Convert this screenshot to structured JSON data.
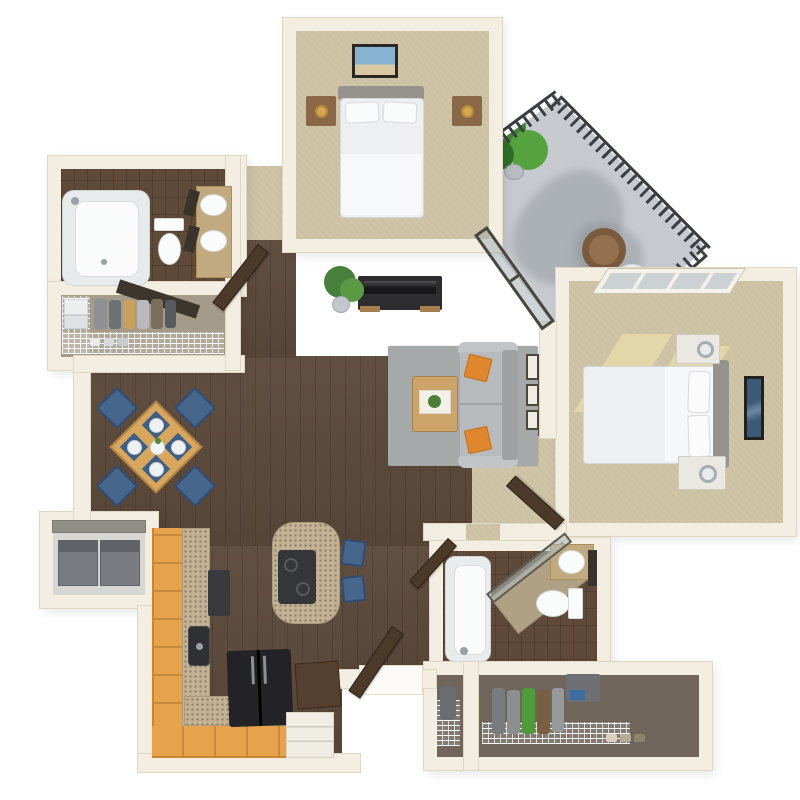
{
  "scene": {
    "description": "3D rendered top-down floor plan of a two-bedroom, two-bathroom apartment with balcony",
    "canvas_px": {
      "width": 800,
      "height": 800
    },
    "background": "#ffffff",
    "visible_text": "none"
  },
  "palette": {
    "wall": "#f3eee1",
    "wall_edge": "#ded7c4",
    "wood_floor": "#5b483a",
    "carpet": "#cdc1a4",
    "carpet_sunlight": "#e9dcab",
    "bathroom_tile": "#5f4a3a",
    "closet_floor": "#a59b8a",
    "closet2_floor": "#6f655a",
    "balcony_concrete": "#c7cbd0",
    "railing_dark": "#3d4146",
    "granite_counter": "#c3b294",
    "cabinet_orange": "#e6a34c",
    "sofa_gray": "#b7bbbd",
    "rug_gray": "#a5a9aa",
    "accent_pillow_orange": "#e0862c",
    "dining_chair_blue": "#47668c",
    "door_brown": "#4b3a29",
    "fixture_white": "#fafbfb",
    "bed_linen": "#edeff1",
    "headboard_gray": "#96938e",
    "nightstand_wood": "#8a6746",
    "nightstand_white": "#eae8e2",
    "lamp_gold": "#d2a74f",
    "plant_green": "#4f8a3c",
    "refrigerator_black": "#232327",
    "tv_black": "#17171a",
    "art_blue": "#3c5a78",
    "art_sky": "#86b4d2",
    "laundry_counter_gray": "#908f88",
    "laundry_machine_gray": "#787c80",
    "coffee_table_wood": "#cda469",
    "dining_table_wood": "#d8a75c"
  },
  "rooms": [
    {
      "id": "bedroom-1",
      "label": "Bedroom 1 (top)",
      "floor": "carpet",
      "furniture": [
        "framed-wall-art",
        "headboard",
        "double-bed",
        "two-pillows",
        "nightstand-left",
        "nightstand-right",
        "gold-table-lamps",
        "open-door"
      ]
    },
    {
      "id": "balcony",
      "label": "Balcony (top right)",
      "floor": "concrete",
      "furniture": [
        "metal-baluster-railing",
        "potted-plant",
        "round-wicker-table",
        "two-patio-chairs",
        "sliding-glass-door"
      ]
    },
    {
      "id": "bedroom-2",
      "label": "Bedroom 2 (right)",
      "floor": "carpet",
      "furniture": [
        "gridded-window",
        "sunlight-patches",
        "double-bed",
        "headboard",
        "two-pillows",
        "nightstand-top",
        "nightstand-bottom",
        "silver-lamps",
        "framed-wall-art",
        "open-door"
      ]
    },
    {
      "id": "bathroom-1",
      "label": "Bathroom 1 (top left)",
      "floor": "tile",
      "furniture": [
        "bathtub-with-shower",
        "toilet",
        "double-sink-vanity",
        "mirrors"
      ]
    },
    {
      "id": "closet-1",
      "label": "Walk-in closet (left)",
      "floor": "closet",
      "furniture": [
        "wire-shelving",
        "hanging-clothes",
        "folded-towels",
        "shoes",
        "corner-shelf"
      ]
    },
    {
      "id": "dining-area",
      "label": "Dining area",
      "floor": "wood",
      "furniture": [
        "square-dining-table",
        "four-blue-chairs",
        "four-place-settings",
        "centerpiece"
      ]
    },
    {
      "id": "living-room",
      "label": "Living room",
      "floor": "wood",
      "furniture": [
        "gray-area-rug",
        "gray-sofa",
        "two-orange-pillows",
        "coffee-table",
        "decorative-tray",
        "tv-console",
        "flat-tv",
        "potted-plant",
        "gallery-wall-frames"
      ]
    },
    {
      "id": "kitchen",
      "label": "Kitchen (bottom left)",
      "floor": "wood",
      "furniture": [
        "l-shaped-orange-cabinets",
        "granite-countertop",
        "undermount-sink",
        "wall-oven",
        "island-with-cooktop",
        "two-blue-bar-stools",
        "black-refrigerator",
        "entry-console",
        "open-shelf-cabinet"
      ]
    },
    {
      "id": "laundry",
      "label": "Laundry closet (left)",
      "floor": "laundry",
      "furniture": [
        "gray-counter",
        "washer",
        "dryer"
      ]
    },
    {
      "id": "entry",
      "label": "Entry (bottom center)",
      "floor": "wood",
      "furniture": [
        "threshold",
        "open-front-door"
      ]
    },
    {
      "id": "bathroom-2",
      "label": "Bathroom 2 (bottom right)",
      "floor": "tile",
      "furniture": [
        "bathtub",
        "glass-shower",
        "toilet",
        "sink-vanity",
        "mirror",
        "open-door"
      ]
    },
    {
      "id": "closet-2",
      "label": "Closet (bottom right)",
      "floor": "closet",
      "furniture": [
        "divider-wall",
        "wire-shelving",
        "hanging-clothes",
        "stacked-clothes",
        "shoes"
      ]
    },
    {
      "id": "hallways",
      "label": "Hallways",
      "floor": "wood-and-carpet",
      "furniture": []
    }
  ]
}
